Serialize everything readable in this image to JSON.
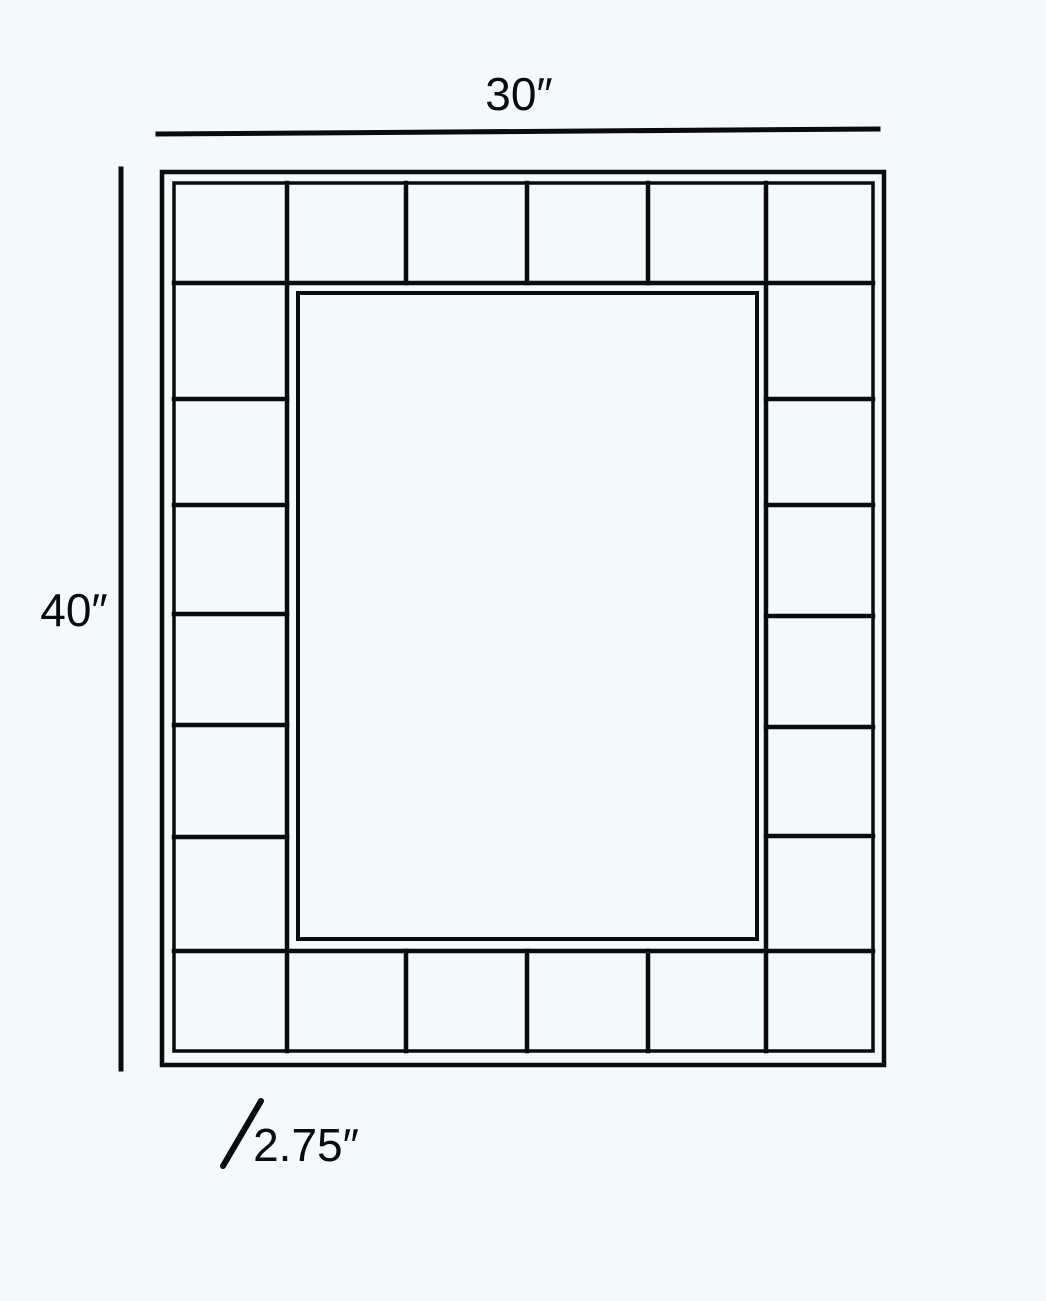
{
  "diagram": {
    "type": "dimension-drawing",
    "subject": "tiled-frame-mirror",
    "colors": {
      "background": "#f4f9fb",
      "ink": "#0b0b0b"
    },
    "width_dimension": {
      "label": "30″",
      "value_inches": 30
    },
    "height_dimension": {
      "label": "40″",
      "value_inches": 40
    },
    "tile_dimension": {
      "label": "2.75″",
      "value_inches": 2.75
    },
    "frame": {
      "top_row_tile_count": 6,
      "bottom_row_tile_count": 6,
      "left_column_tile_count": 6,
      "right_column_tile_count": 6,
      "has_inner_lining": true,
      "has_center_panel": true
    }
  }
}
